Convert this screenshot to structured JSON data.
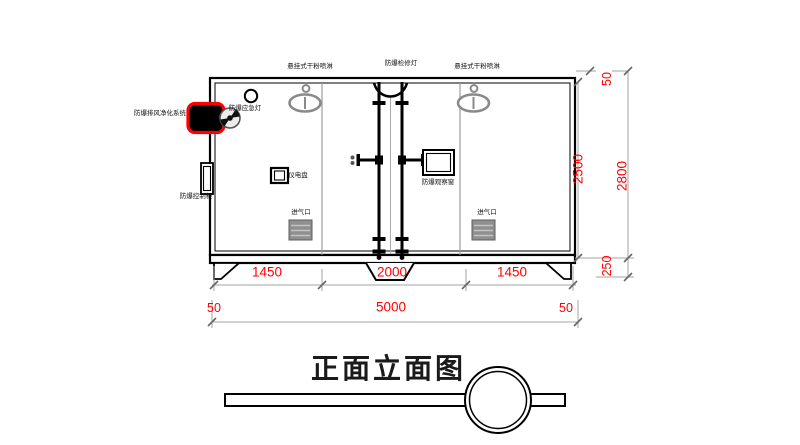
{
  "title": {
    "text": "正面立面图"
  },
  "labels": {
    "sprinkler_left": "悬挂式干粉喷淋",
    "inspection_light": "防爆检修灯",
    "sprinkler_right": "悬挂式干粉喷淋",
    "emergency_light": "防爆应急灯",
    "exhaust_purification": "防爆排风净化系统",
    "control_cabinet": "防爆控制柜",
    "power_panel": "仪电盘",
    "observation_window": "防爆观察窗",
    "air_inlet_left": "进气口",
    "air_inlet_right": "进气口"
  },
  "dimensions": {
    "width_segments": [
      "1450",
      "2000",
      "1450"
    ],
    "overall_width": "5000",
    "left_offset": "50",
    "right_offset": "50",
    "body_height": "2500",
    "roof_offset": "50",
    "overall_height": "2800",
    "leg_height": "250"
  },
  "icons": {
    "fan_unit": "fan-icon",
    "sprinkler": "sprinkler-icon",
    "emergency_light": "round-lamp-icon",
    "air_inlet": "louver-grille-icon"
  },
  "colors": {
    "dimension_text": "#fe0000",
    "highlight_outline": "#fe0000",
    "drawing_line": "#000000",
    "dim_line": "#a3a3a3",
    "partition_line": "#9c9c9c",
    "sprinkler_gray": "#8a8a8a"
  }
}
